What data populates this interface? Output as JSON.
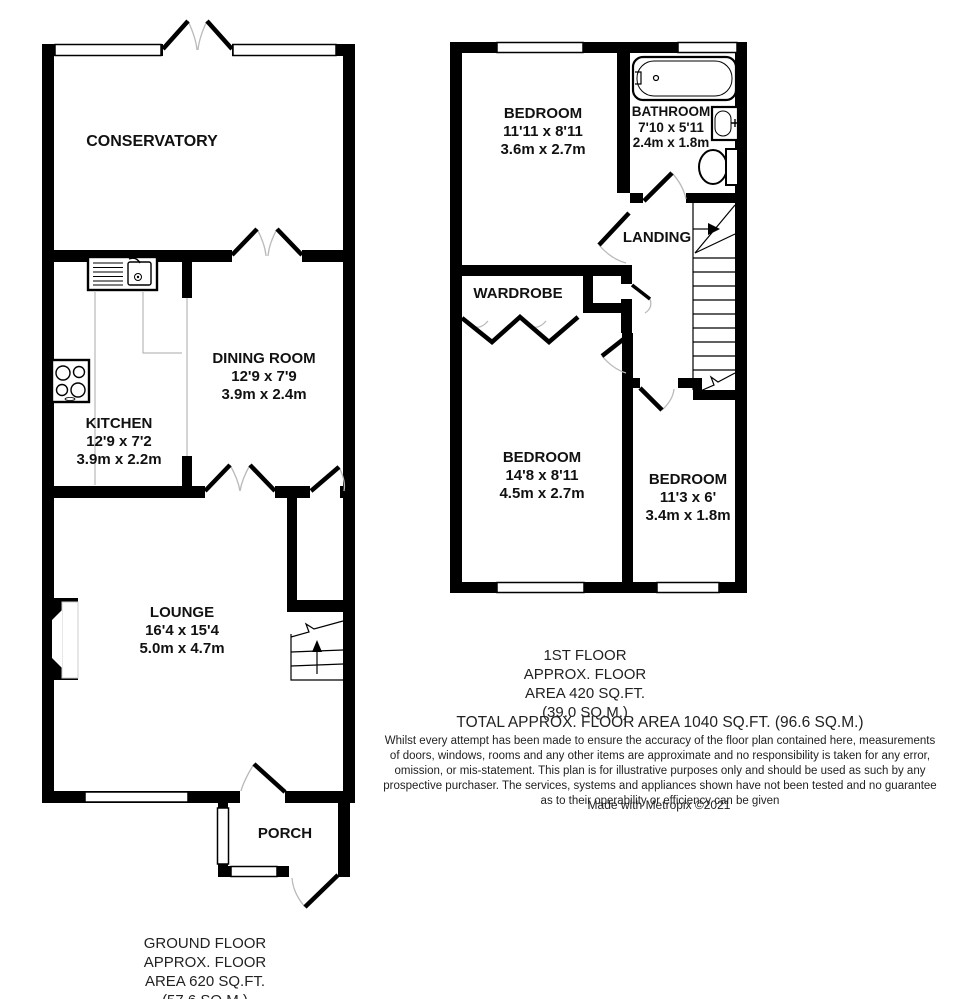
{
  "ground_floor": {
    "rooms": {
      "conservatory": {
        "name": "CONSERVATORY"
      },
      "dining": {
        "name": "DINING ROOM",
        "dims_ft": "12'9 x 7'9",
        "dims_m": "3.9m x 2.4m"
      },
      "kitchen": {
        "name": "KITCHEN",
        "dims_ft": "12'9 x 7'2",
        "dims_m": "3.9m x 2.2m"
      },
      "lounge": {
        "name": "LOUNGE",
        "dims_ft": "16'4 x 15'4",
        "dims_m": "5.0m x 4.7m"
      },
      "porch": {
        "name": "PORCH"
      }
    },
    "footer_lines": [
      "GROUND FLOOR",
      "APPROX. FLOOR",
      "AREA 620 SQ.FT.",
      "(57.6 SQ.M.)"
    ]
  },
  "first_floor": {
    "rooms": {
      "bedroom1": {
        "name": "BEDROOM",
        "dims_ft": "11'11 x 8'11",
        "dims_m": "3.6m x 2.7m"
      },
      "bathroom": {
        "name": "BATHROOM",
        "dims_ft": "7'10 x 5'11",
        "dims_m": "2.4m x 1.8m"
      },
      "landing": {
        "name": "LANDING"
      },
      "wardrobe": {
        "name": "WARDROBE"
      },
      "bedroom2": {
        "name": "BEDROOM",
        "dims_ft": "14'8 x 8'11",
        "dims_m": "4.5m x 2.7m"
      },
      "bedroom3": {
        "name": "BEDROOM",
        "dims_ft": "11'3 x 6'",
        "dims_m": "3.4m x 1.8m"
      }
    },
    "footer_lines": [
      "1ST FLOOR",
      "APPROX. FLOOR",
      "AREA 420 SQ.FT.",
      "(39.0 SQ.M.)"
    ]
  },
  "summary": {
    "total_area": "TOTAL APPROX. FLOOR AREA 1040 SQ.FT. (96.6 SQ.M.)",
    "disclaimer_lines": [
      "Whilst every attempt has been made to ensure the accuracy of the floor plan contained here, measurements",
      "of doors, windows, rooms and any other items are approximate and no responsibility is taken for any error,",
      "omission, or mis-statement. This plan is for illustrative purposes only and should be used as such by any",
      "prospective purchaser. The services, systems and appliances shown have not been tested and no guarantee",
      "as to their operability or efficiency can be given"
    ],
    "credit": "Made with Metropix ©2021"
  },
  "colors": {
    "wall": "#000000",
    "background": "#ffffff",
    "door_arc": "#b9b9b9",
    "counter_line": "#aaaaaa"
  }
}
